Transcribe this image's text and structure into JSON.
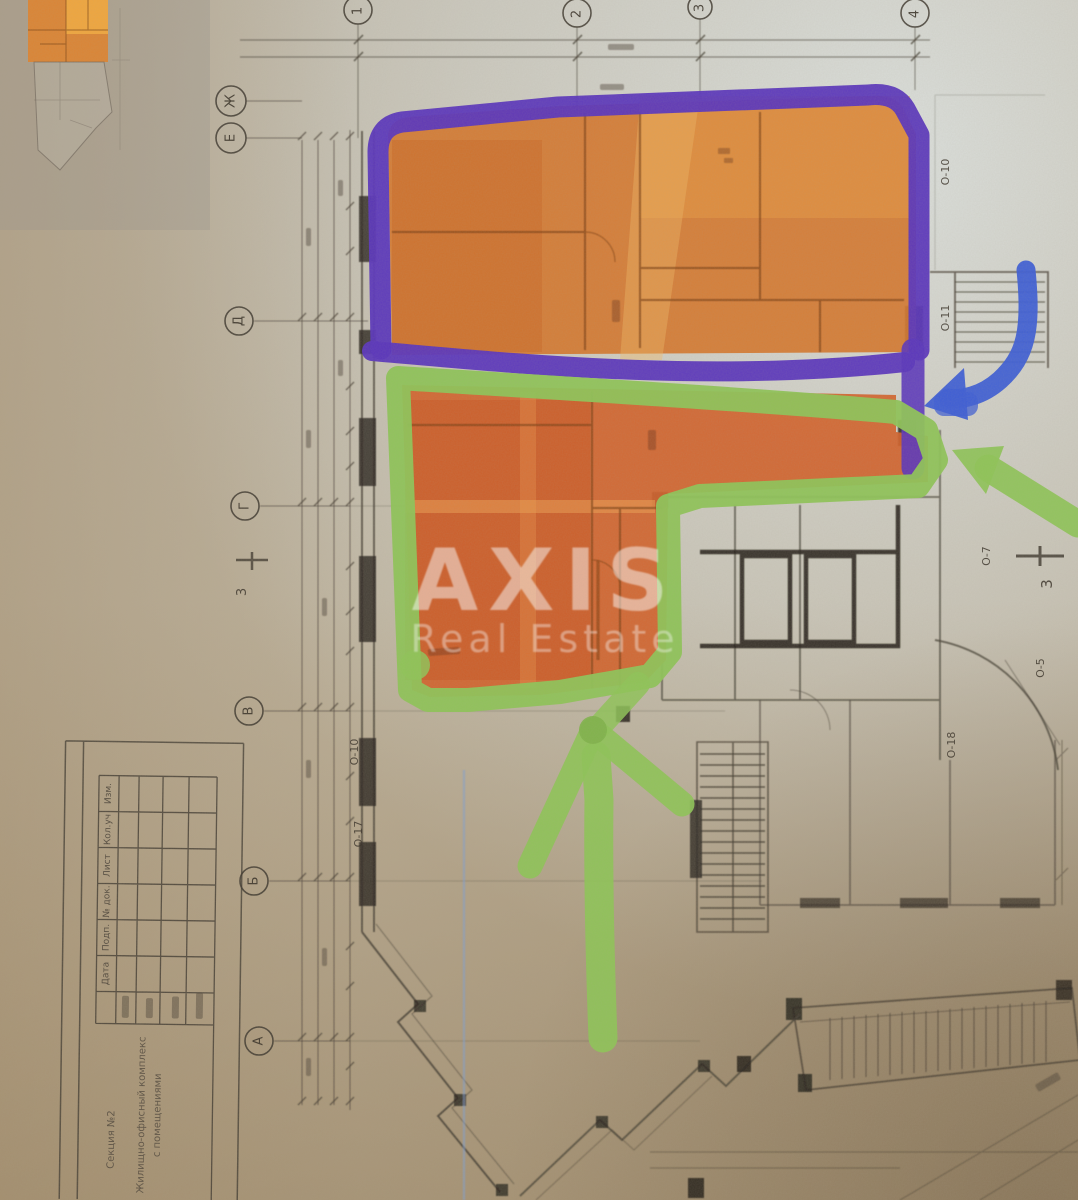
{
  "watermark": {
    "brand": "AXIS",
    "subtitle": "Real Estate"
  },
  "colors": {
    "upper_unit_highlight": "#d5772e",
    "upper_unit_light": "#e89a42",
    "lower_unit_highlight": "#d2622a",
    "purple_outline": "#5a35bd",
    "green_outline": "#8ec457",
    "green_arrow": "#8ec457",
    "blue_arrow": "#3d5ed6",
    "paper_tan": "#b7a88e",
    "paper_light": "#d8dbd8",
    "ink": "#453e33"
  },
  "grid_markers": {
    "rows": [
      "Ж",
      "Е",
      "Д",
      "Г",
      "В",
      "Б",
      "А"
    ],
    "cols": [
      "1",
      "2",
      "3",
      "4"
    ]
  },
  "opening_tags": {
    "right": [
      "О-10",
      "О-11",
      "О-7",
      "О-5",
      "О-18"
    ],
    "left": [
      "О-10",
      "О-17"
    ],
    "section_marks": [
      "3",
      "3"
    ]
  },
  "title_block": {
    "headers": [
      "Изм.",
      "Кол.уч",
      "Лист",
      "№ док.",
      "Подп.",
      "Дата"
    ],
    "project_line1": "Жилищно-офисный комплекс",
    "project_line2": "с помещениями",
    "section_label": "Секция №2"
  }
}
